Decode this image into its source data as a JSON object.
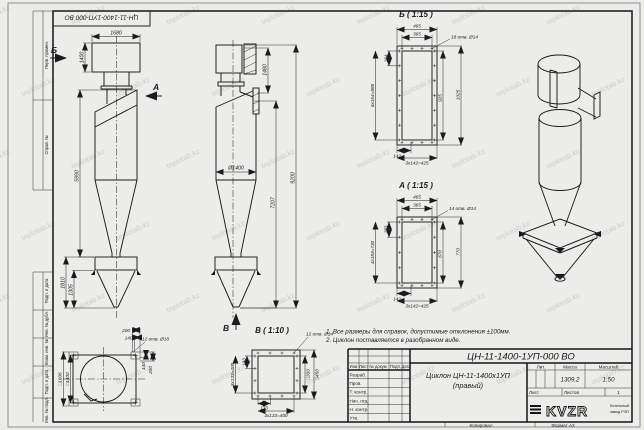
{
  "watermark": "teplotab.kz",
  "colors": {
    "paper": "#ececea",
    "line": "#1b1b1b",
    "watermark": "#a9b2ab"
  },
  "frame": {
    "margins": [
      "Перв. примен.",
      "Справ. №",
      "Подп. и дата",
      "Инв. № дубл.",
      "Взам. инв. №",
      "Подп. и дата",
      "Инв. № подл."
    ],
    "copied": "Копировал",
    "format": "Формат А3"
  },
  "notes": {
    "line1": "1. Все размеры для справок, допустимые отклонения ±100мм.",
    "line2": "2. Циклон поставляется в разобранном виде."
  },
  "views": {
    "front": {
      "label_b": "Б",
      "label_a": "А",
      "dims": {
        "w1680": "1680",
        "h1400": "1400",
        "h5990": "5990",
        "h1810": "1810",
        "h1305": "1305"
      }
    },
    "side": {
      "label_v": "В",
      "dims": {
        "h1480": "1480",
        "h7207": "7207",
        "h9200": "9200",
        "d1400": "Ø1400"
      }
    },
    "flange_top": {
      "dims": {
        "t200": "200",
        "t140": "140",
        "holes": "12 отв. Ø18",
        "s1606": "□1606",
        "s1400": "□1400",
        "r140": "140",
        "r200": "200"
      }
    },
    "v_view": {
      "title": "В ( 1:10 )",
      "dims": {
        "holes": "12 отв. Ø14",
        "l133": "133",
        "l3x133": "3х133=400",
        "b133": "133",
        "b3x133": "3х133=400",
        "s350": "□350",
        "s450": "□450"
      }
    },
    "b_view": {
      "title": "Б ( 1:15 )",
      "dims": {
        "holes": "18 отв. Ø14",
        "w465": "465",
        "w365": "365",
        "s164": "164",
        "v6x164": "6х164=985",
        "r925": "925",
        "r1025": "1025",
        "b142": "142",
        "b3x142": "3х142=425"
      }
    },
    "a_view": {
      "title": "А ( 1:15 )",
      "dims": {
        "holes": "14 отв. Ø14",
        "w465": "465",
        "w365": "365",
        "s183": "183",
        "v4x183": "4х183=730",
        "r670": "670",
        "r770": "770",
        "b142": "142",
        "b3x142": "3х142=425"
      }
    }
  },
  "titleblock": {
    "designation": "ЦН-11-1400-1УП-000 ВО",
    "name_line1": "Циклон ЦН-11-1400х1УП",
    "name_line2": "(правый)",
    "header": {
      "izm": "Изм",
      "list": "Лист",
      "doc": "№ докум.",
      "podp": "Подп.",
      "data": "Дата"
    },
    "rows": [
      "Разраб.",
      "Пров.",
      "Т. контр.",
      "Нач. отд.",
      "Н. контр.",
      "Утв."
    ],
    "lit_label": "Лит.",
    "mass_label": "Масса",
    "scale_label": "Масштаб",
    "mass": "1309,2",
    "scale": "1:50",
    "sheet_label": "Лист",
    "sheets_label": "Листов",
    "sheets_value": "1",
    "logo": "KVZR",
    "company_line1": "Котельный",
    "company_line2": "завод РЭП"
  }
}
